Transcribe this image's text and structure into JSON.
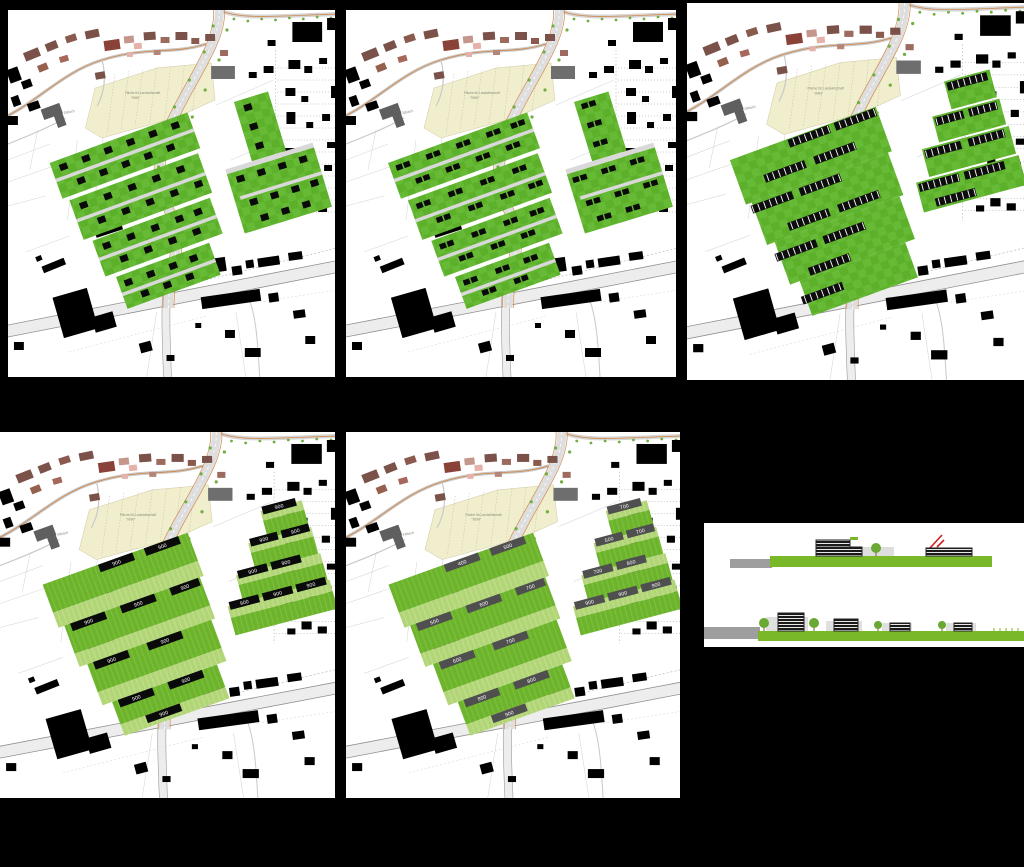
{
  "scene": {
    "background": "#000000",
    "description_labels": {
      "stream": "Jabach",
      "field_line1": "Fläche für Landwirtschaft",
      "field_line2": "\"9090\""
    }
  },
  "colors": {
    "parcel_green": "#5fb32b",
    "parcel_green_light": "#b2d578",
    "building_black": "#0a0a0a",
    "building_gray": "#4f4f4f",
    "existing_brown": "#7b5249",
    "field_beige": "#f1eecd",
    "road_orange": "#d08a4e",
    "section_green": "#79b829",
    "accent_red": "#cc2222"
  },
  "variants": {
    "v4": {
      "labels": [
        "900",
        "900",
        "900",
        "900",
        "900",
        "900",
        "900",
        "900",
        "900",
        "900",
        "900",
        "900",
        "900",
        "900",
        "900",
        "900",
        "900",
        "900"
      ]
    },
    "v5": {
      "west_labels": [
        "400",
        "500",
        "500",
        "600",
        "700",
        "600",
        "700",
        "800",
        "800",
        "900"
      ],
      "east_labels": [
        "700",
        "500",
        "700",
        "700",
        "800",
        "900",
        "900",
        "900"
      ]
    }
  }
}
